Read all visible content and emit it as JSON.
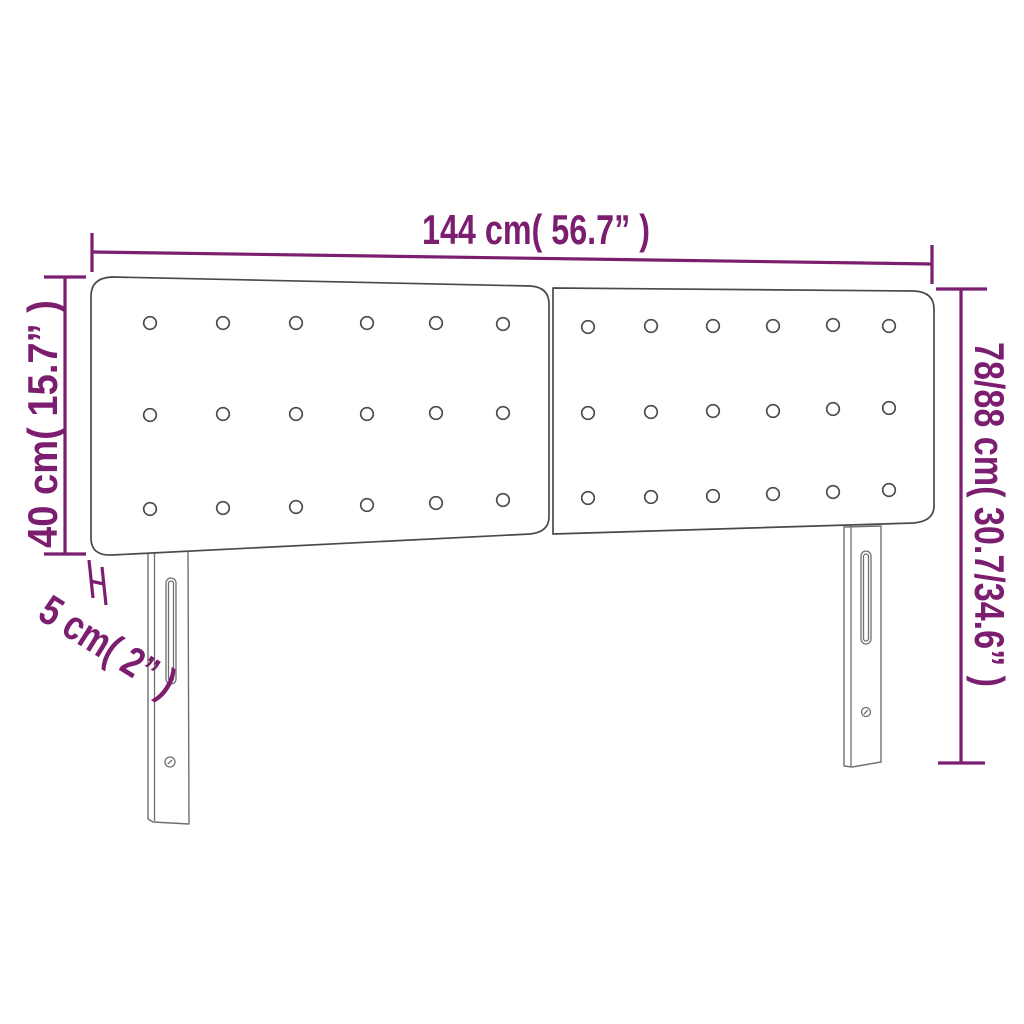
{
  "diagram": {
    "description": "Technical dimension diagram of a two-panel button-tufted bed headboard with two slotted mounting legs",
    "background_color": "#ffffff",
    "colors": {
      "dimension": "#7c1e6f",
      "panel_outline": "#4a4a4a",
      "leg_outline": "#707070"
    },
    "labels": {
      "width": "144 cm( 56.7” )",
      "panel_height": "40 cm( 15.7” )",
      "total_height": "78/88 cm( 30.7/34.6” )",
      "depth": "5 cm( 2” )"
    },
    "measurements": {
      "width_cm": "144",
      "width_inch": "56.7",
      "panel_height_cm": "40",
      "panel_height_inch": "15.7",
      "total_height_cm": "78/88",
      "total_height_inch": "30.7/34.6",
      "depth_cm": "5",
      "depth_inch": "2"
    },
    "panels": {
      "count": 2,
      "button_rows": 3,
      "button_cols": 6,
      "button_radius": 6.3,
      "left_buttons": [
        [
          150,
          323
        ],
        [
          223,
          323
        ],
        [
          296,
          323
        ],
        [
          367,
          323
        ],
        [
          436,
          323
        ],
        [
          503,
          324
        ],
        [
          150,
          415
        ],
        [
          223,
          414
        ],
        [
          296,
          414
        ],
        [
          367,
          414
        ],
        [
          436,
          413
        ],
        [
          503,
          413
        ],
        [
          150,
          509
        ],
        [
          223,
          508
        ],
        [
          296,
          507
        ],
        [
          367,
          505
        ],
        [
          436,
          503
        ],
        [
          503,
          500
        ]
      ],
      "right_buttons": [
        [
          588,
          327
        ],
        [
          651,
          326
        ],
        [
          713,
          326
        ],
        [
          773,
          326
        ],
        [
          833,
          325
        ],
        [
          889,
          326
        ],
        [
          588,
          413
        ],
        [
          651,
          412
        ],
        [
          713,
          411
        ],
        [
          773,
          411
        ],
        [
          833,
          409
        ],
        [
          889,
          408
        ],
        [
          588,
          498
        ],
        [
          651,
          497
        ],
        [
          713,
          496
        ],
        [
          773,
          494
        ],
        [
          833,
          492
        ],
        [
          889,
          490
        ]
      ]
    }
  }
}
